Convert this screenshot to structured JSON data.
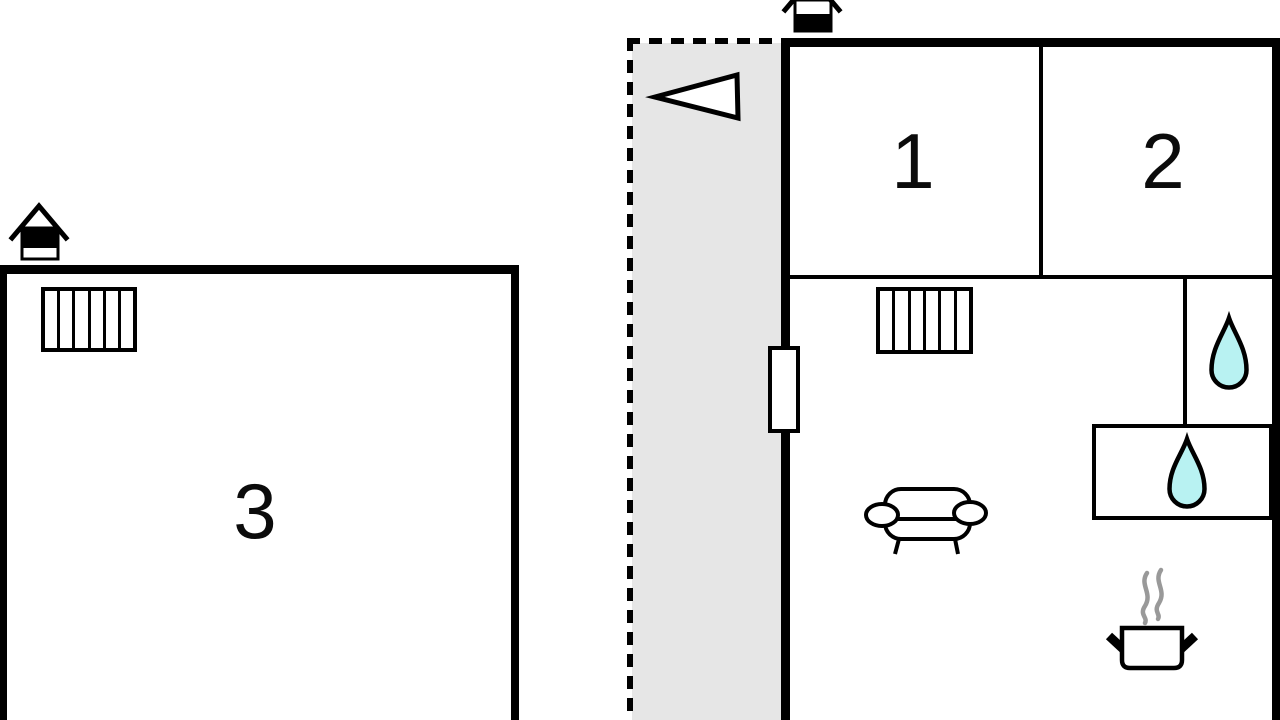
{
  "type": "floor-plan",
  "rooms": [
    {
      "id": "room-1",
      "label": "1"
    },
    {
      "id": "room-2",
      "label": "2"
    },
    {
      "id": "room-3",
      "label": "3"
    }
  ],
  "colors": {
    "wall": "#000000",
    "corridor": "#e6e6e6",
    "water": "#b8f2f2",
    "steam": "#999999",
    "bg": "#ffffff"
  },
  "icons": [
    "chimney-icon-left",
    "chimney-icon-top",
    "entrance-arrow-icon",
    "stairs-icon-left",
    "stairs-icon-right",
    "entrance-door",
    "water-drop-icon",
    "water-drop-icon",
    "sofa-icon",
    "cooking-pot-icon"
  ]
}
